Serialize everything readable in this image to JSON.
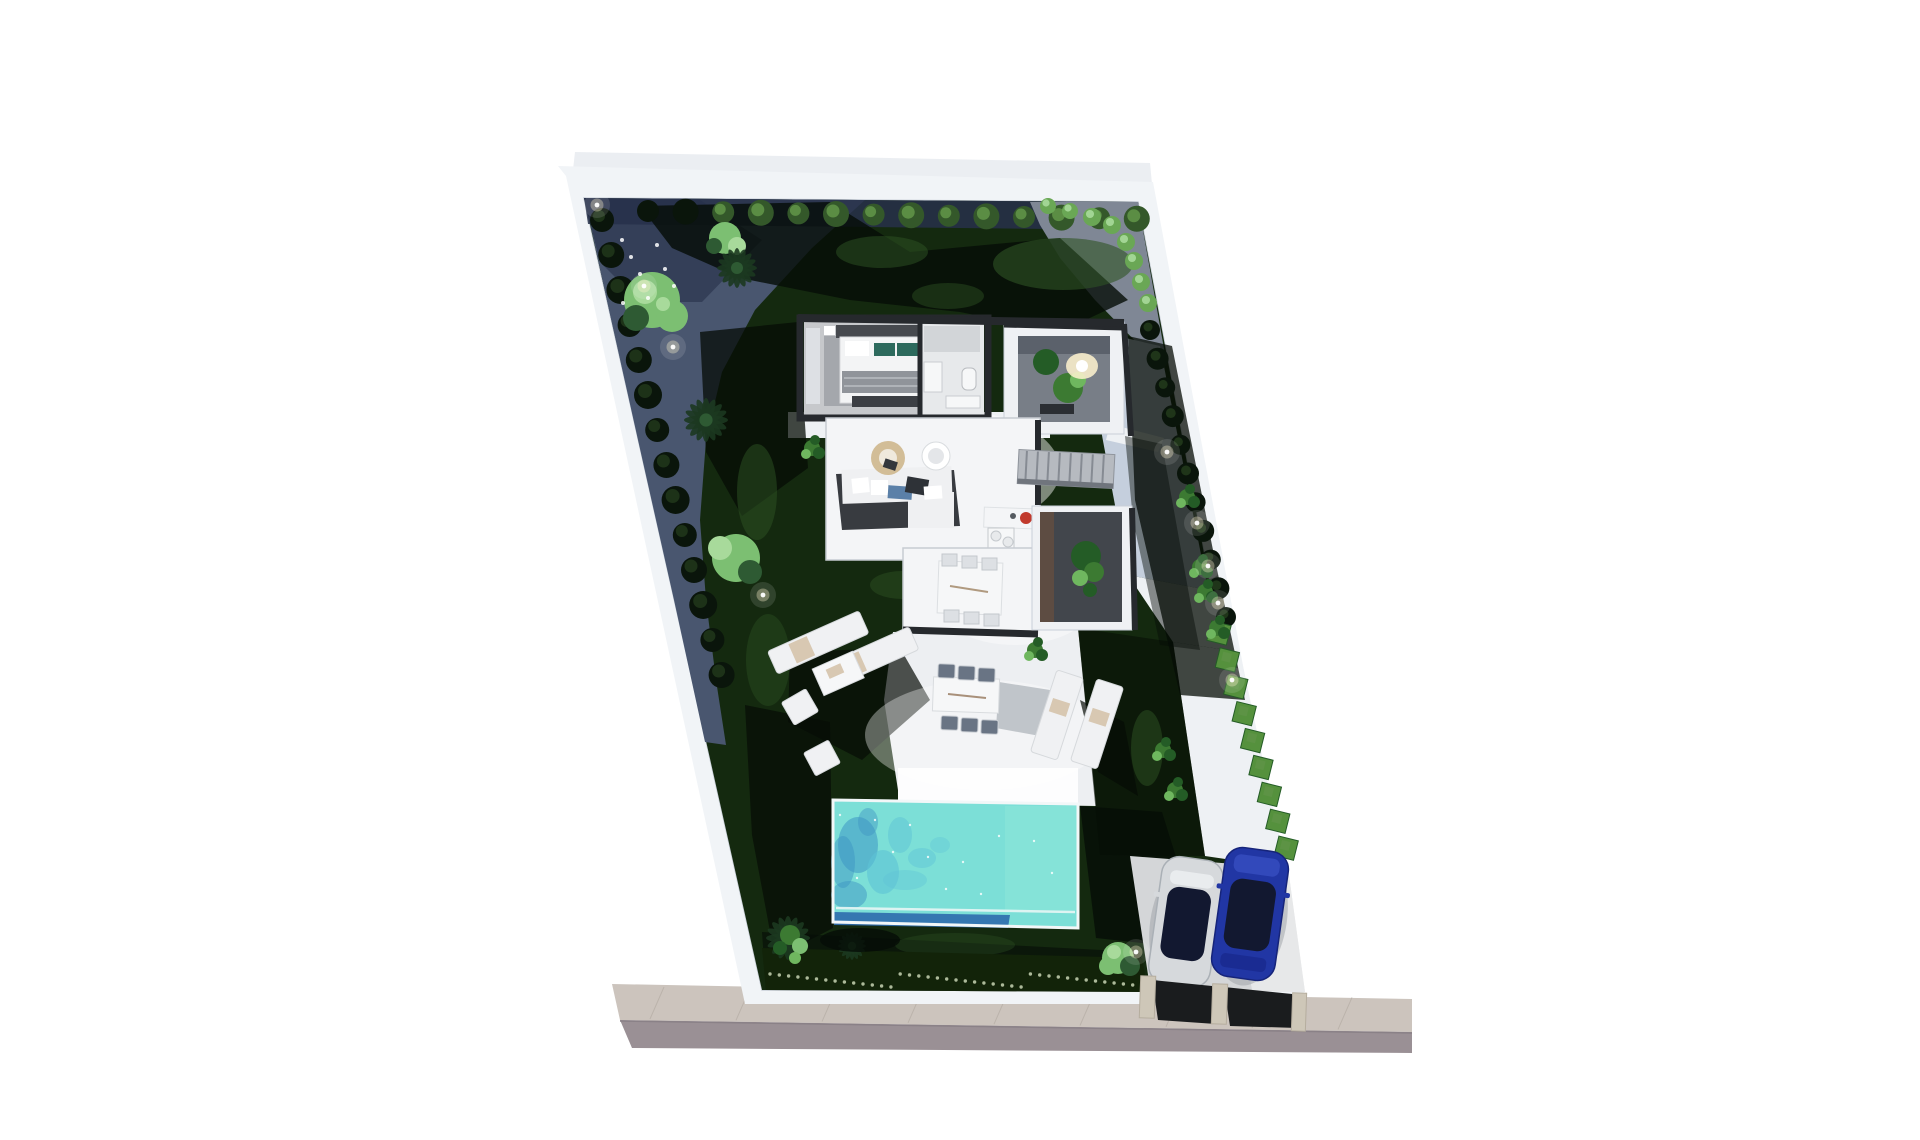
{
  "scene": {
    "description": "3D rendered top-down site plan of a modern single-storey villa on a slanted (parallelogram) plot at night-lit dusk, with garden, pool, terraces and parking beside a street",
    "areas": [
      "boundary wall",
      "gravel garden",
      "lawn",
      "palm trees",
      "ornamental bushes",
      "villa floor plan",
      "bedroom",
      "bathroom",
      "entrance patio with tree",
      "living room",
      "kitchen island",
      "indoor dining room",
      "inner courtyard planter",
      "staircase",
      "sun terrace",
      "outdoor dining set",
      "sun loungers",
      "lounge chairs",
      "swimming pool",
      "square hedge row",
      "garden lights",
      "parking pad with two cars",
      "driveway",
      "sidewalk",
      "road"
    ]
  },
  "colors": {
    "background": "#ffffff",
    "wallFill": "#f1f4f7",
    "wallEdge": "#c9cfd8",
    "washGray": "#e4e8ee",
    "lawn": "#14290f",
    "lawnDark": "#071106",
    "lawnLight": "#2e5424",
    "gravelBlue": "#49566f",
    "gravelBlueDark": "#27304a",
    "gravelGray": "#7f8795",
    "pathBlue": "#c5cfdd",
    "pathWhite": "#eef1f4",
    "terrace": "#edeff2",
    "terraceBright": "#fdfdfe",
    "houseWall": "#26292d",
    "glass": "#c7ccd2",
    "bedroomFloor": "#c6c8cb",
    "rug": "#a4a7ac",
    "bedWhite": "#f3f4f5",
    "bedHeader": "#46494e",
    "pillowTeal": "#2d6a5d",
    "blanket": "#90949a",
    "benchWood": "#c9b699",
    "bathFloor": "#e7e9eb",
    "fixtureWhite": "#f6f7f8",
    "fixtureGray": "#c9ccd0",
    "courtyardFrame": "#eff1f4",
    "courtyardFloor": "#787e87",
    "courtyardWall": "#5b616b",
    "plantGreen": "#3c7a32",
    "plantDark": "#245c26",
    "plantLight": "#6fb75f",
    "glowWarm": "#fff3cf",
    "white": "#ffffff",
    "sofaWhite": "#eff0f2",
    "sofaFloor": "#383b40",
    "pillowBlue": "#5b80a8",
    "pillowDark": "#2e3237",
    "tableWood": "#d2bd97",
    "kitchenWhite": "#f4f5f7",
    "redAppliance": "#c13a2d",
    "stairGray": "#b6bac0",
    "stairLine": "#868b93",
    "innerCourtyard": "#42464c",
    "sideboardBrown": "#5d4c42",
    "chairSeat": "#697484",
    "chairWhite": "#dde0e4",
    "pool": "#7cdfd7",
    "poolRippleLight": "#5ec3d6",
    "poolRippleDark": "#3d95c4",
    "poolEdgeDark": "#2e6bad",
    "poolRim": "#f2f7f8",
    "poolLightEnd": "#8ce6d8",
    "loungerWhite": "#f0f1f3",
    "towelBeige": "#d8c8b2",
    "shadow": "#050c06",
    "terraceShadow": "#8e959e",
    "carSilver": "#d6d9dc",
    "carSilverDark": "#aab0b6",
    "carBlue": "#2136a4",
    "carBlueLight": "#3a51c4",
    "carBlueDark": "#16247a",
    "carGlass": "#121830",
    "parkingPad": "#d4d6d8",
    "driveway": "#1a1c1e",
    "pillarStone": "#cec7b8",
    "pillarStoneEdge": "#b5ad9e",
    "sidewalk": "#ccc4bd",
    "sidewalkLine": "#b7afa7",
    "road": "#9a9095",
    "roadEdge": "#8a8187",
    "hedgeDark": "#122309",
    "hedgeLight": "#c8d3b4",
    "bushDark": "#0a150b",
    "bushDarkTop": "#1f3519",
    "bushGreen": "#34582a",
    "bushGreenTop": "#5f9447",
    "bushLight": "#6aa755",
    "squareHedge": "#55913d",
    "treeLight": "#7cbf72",
    "treeLighter": "#a8da9b",
    "palmDark": "#1c3920",
    "palmMid": "#2e5a33"
  }
}
